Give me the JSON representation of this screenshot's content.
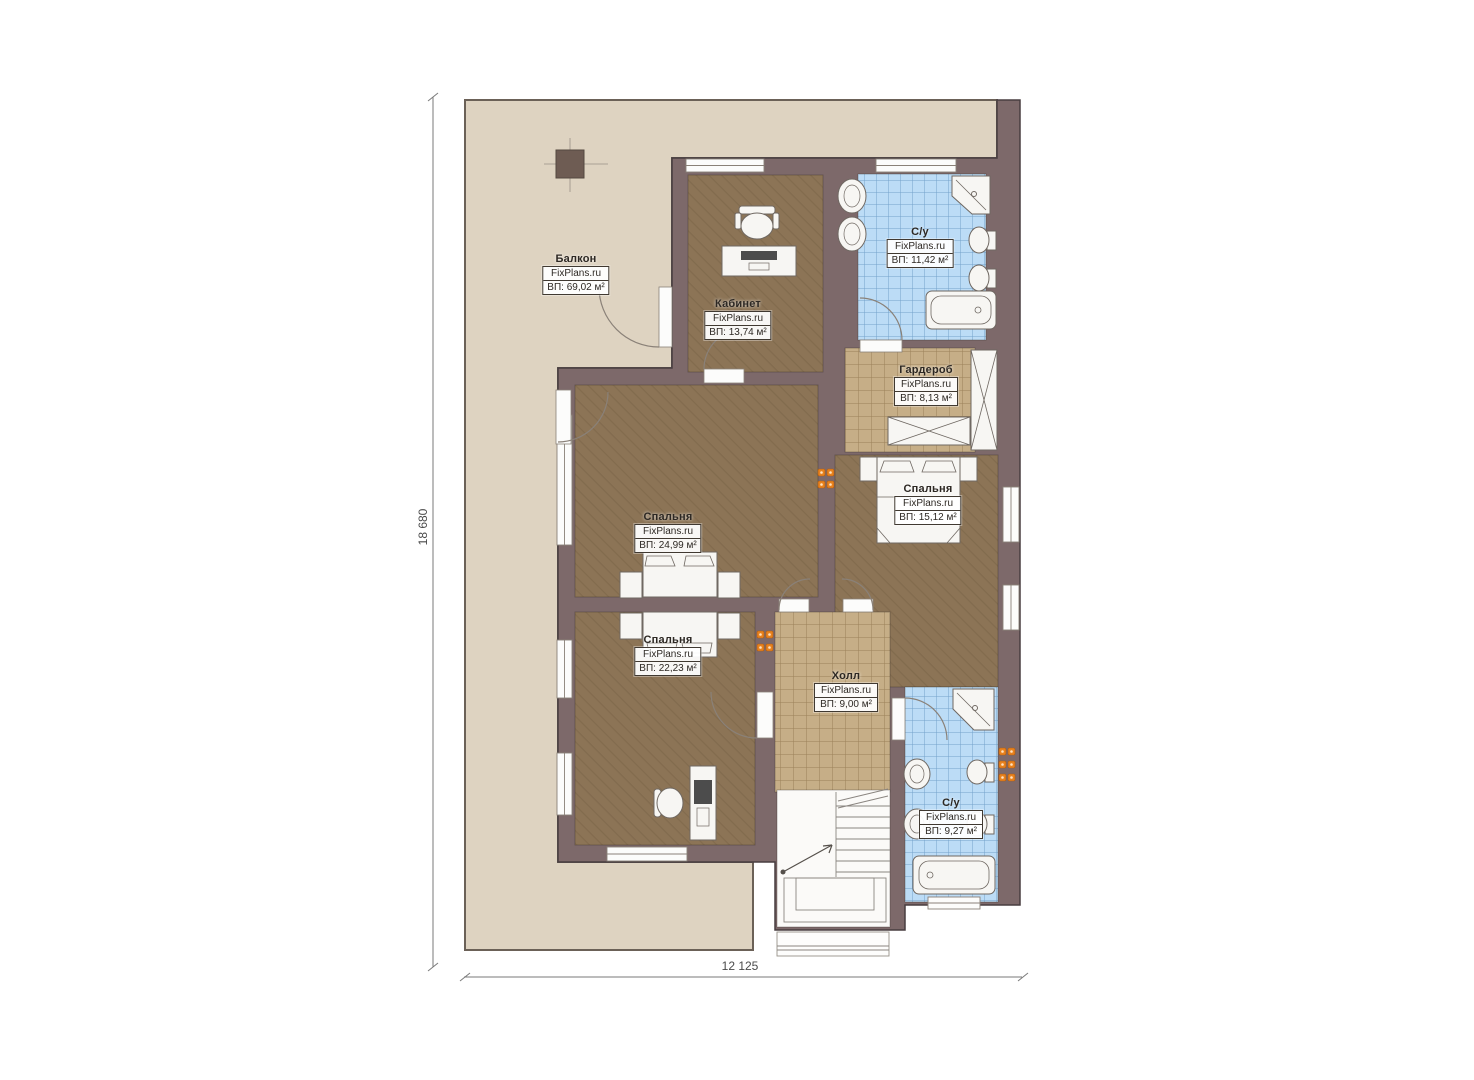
{
  "plan": {
    "rooms": [
      {
        "name": "Балкон",
        "brand": "FixPlans.ru",
        "area": "ВП: 69,02 м²"
      },
      {
        "name": "Кабинет",
        "brand": "FixPlans.ru",
        "area": "ВП: 13,74 м²"
      },
      {
        "name": "С/у",
        "brand": "FixPlans.ru",
        "area": "ВП: 11,42 м²"
      },
      {
        "name": "Гардероб",
        "brand": "FixPlans.ru",
        "area": "ВП: 8,13 м²"
      },
      {
        "name": "Спальня",
        "brand": "FixPlans.ru",
        "area": "ВП: 15,12 м²"
      },
      {
        "name": "Спальня",
        "brand": "FixPlans.ru",
        "area": "ВП: 24,99 м²"
      },
      {
        "name": "Спальня",
        "brand": "FixPlans.ru",
        "area": "ВП: 22,23 м²"
      },
      {
        "name": "Холл",
        "brand": "FixPlans.ru",
        "area": "ВП: 9,00 м²"
      },
      {
        "name": "С/у",
        "brand": "FixPlans.ru",
        "area": "ВП: 9,27 м²"
      }
    ],
    "dimensions": {
      "height": "18 680",
      "width": "12 125"
    },
    "colors": {
      "wall": "#7d696a",
      "wood_floor": "#8c7456",
      "tile_floor": "#c6ae87",
      "bath_floor": "#bcdcf6",
      "balcony_floor": "#ded3c1",
      "radiator": "#e8821e"
    }
  }
}
